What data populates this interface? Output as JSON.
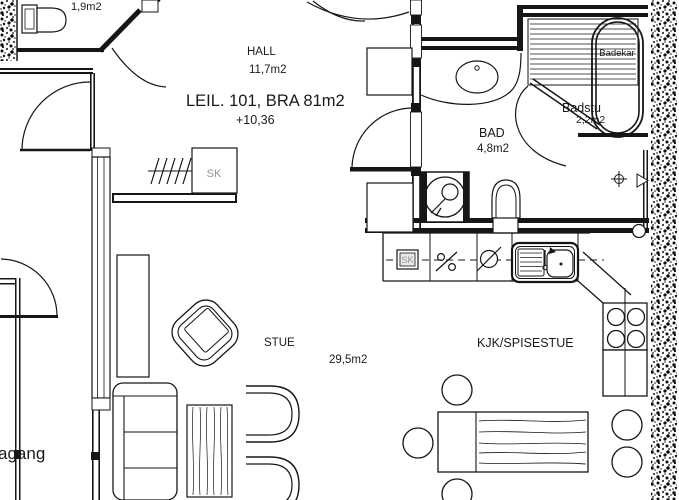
{
  "floorplan": {
    "unit_label": "LEIL. 101, BRA 81m2",
    "elevation": "+10,36",
    "rooms": {
      "wc": {
        "area": "1,9m2"
      },
      "hall": {
        "name": "HALL",
        "area": "11,7m2"
      },
      "bad": {
        "name": "BAD",
        "area": "4,8m2"
      },
      "badstu": {
        "name": "Badstu",
        "area": "2,2m2"
      },
      "stue": {
        "name": "STUE",
        "area": "29,5m2"
      },
      "kitchen": {
        "name": "KJK/SPISESTUE"
      },
      "corridor": {
        "name": "agang"
      }
    },
    "fixtures": {
      "bathtub_label": "Badekar",
      "hall_wardrobe_label": "SK",
      "kitchen_cabinet_label": "SK"
    },
    "colors": {
      "line": "#1a1a1a",
      "muted_label": "#969696",
      "background": "#ffffff"
    }
  }
}
